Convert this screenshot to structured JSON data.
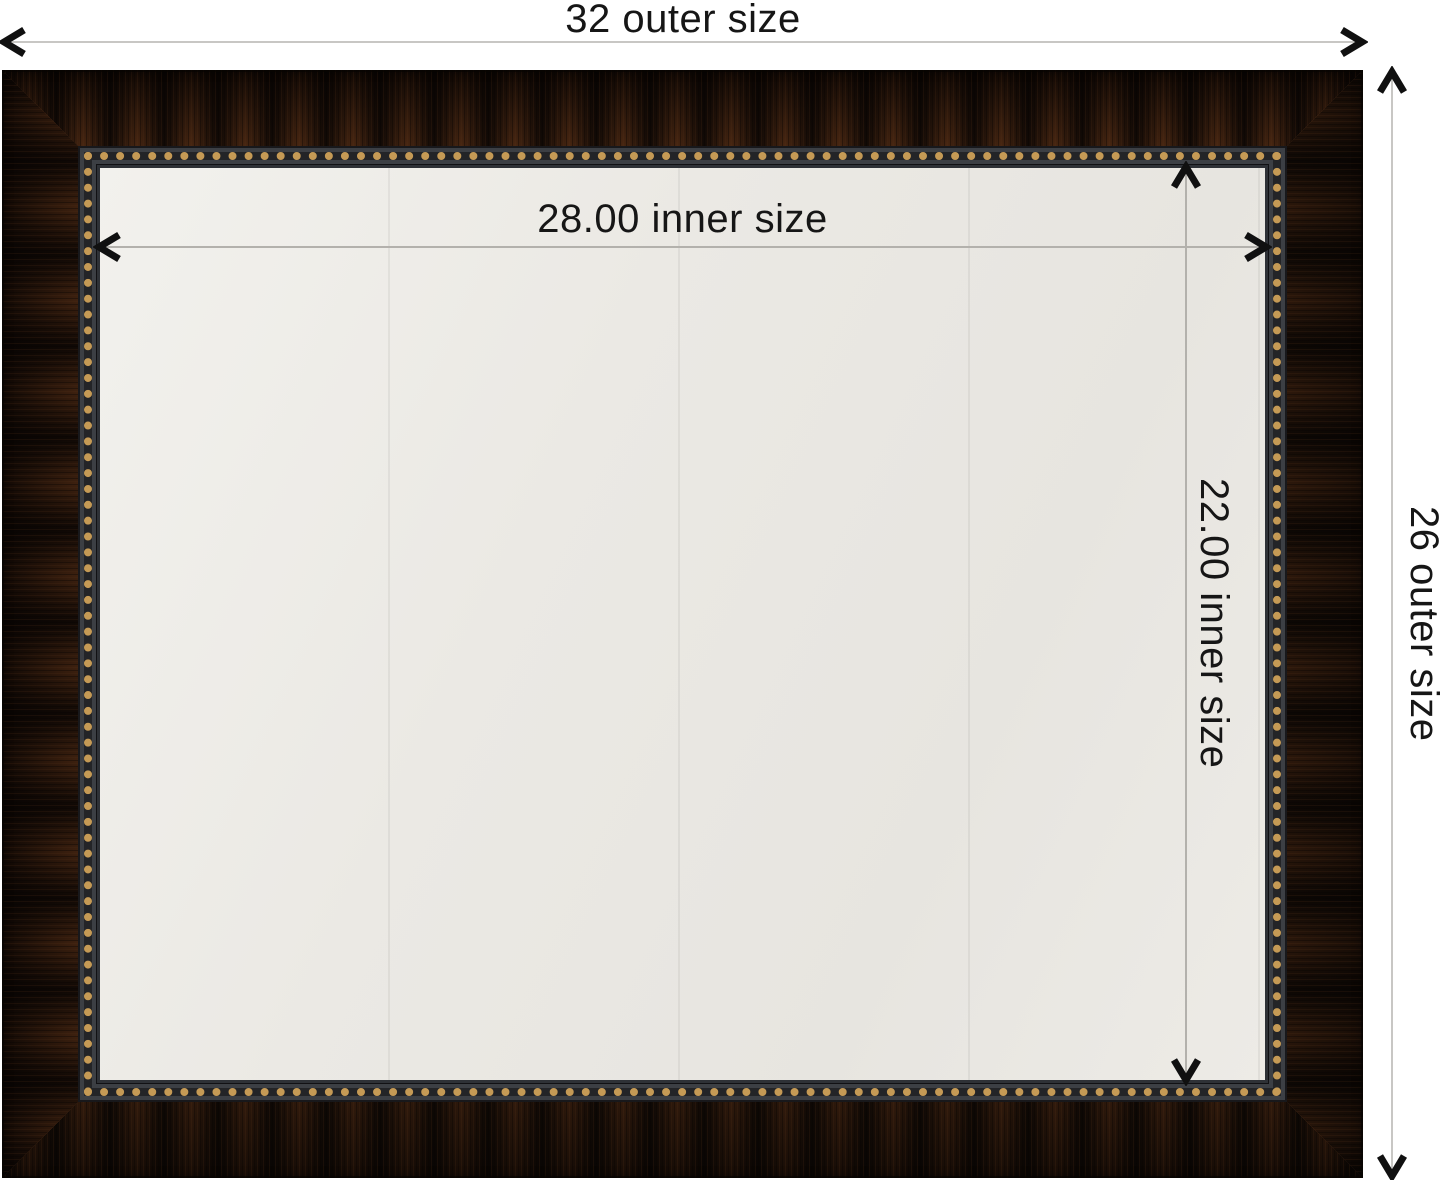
{
  "diagram": {
    "type": "product-dimension-diagram",
    "subject": "framed wall mirror, bronze wood moulding with gold beaded inner trim",
    "labels": {
      "outer_width": "32 outer size",
      "outer_height": "26 outer size",
      "inner_width": "28.00 inner size",
      "inner_height": "22.00 inner size"
    },
    "values": {
      "outer_width": 32,
      "outer_height": 26,
      "inner_width": 28.0,
      "inner_height": 22.0
    }
  },
  "icons": {
    "arrow_left": "chevron-arrowhead-left",
    "arrow_right": "chevron-arrowhead-right",
    "arrow_up": "chevron-arrowhead-up",
    "arrow_down": "chevron-arrowhead-down"
  },
  "colors": {
    "background": "#ffffff",
    "frame_wood_dark": "#1d120a",
    "frame_copper_highlight": "#a45c2a",
    "trim_charcoal": "#3c3f44",
    "bead_gold": "#c59a55",
    "mirror_surface": "#eae8e3",
    "dimension_line": "#c8c7c4",
    "arrow": "#101010",
    "label_text": "#161616"
  }
}
